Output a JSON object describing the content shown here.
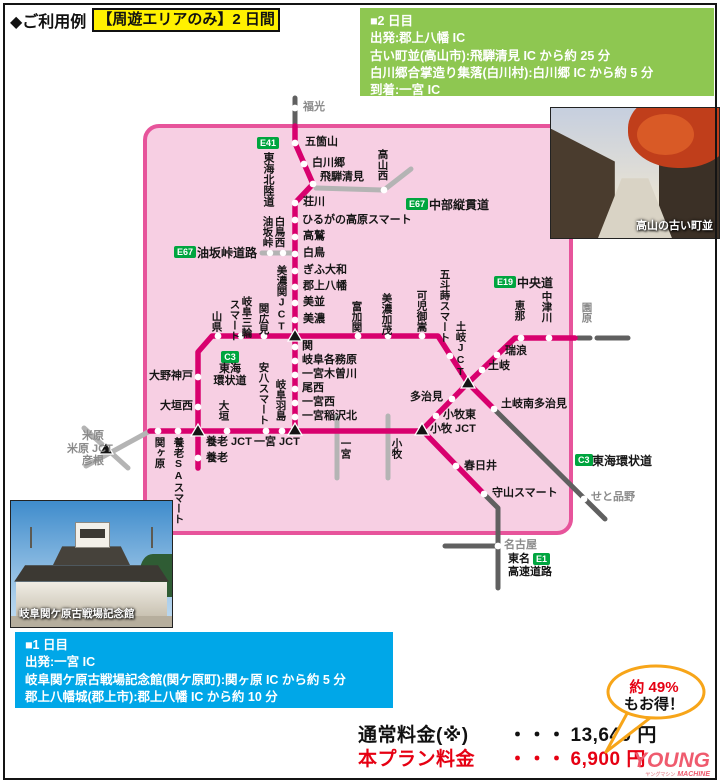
{
  "header": {
    "title": "◆ご利用例",
    "badge": "【周遊エリアのみ】2 日間"
  },
  "day2_box": {
    "lines": [
      "■2 日目",
      "出発:郡上八幡 IC",
      "古い町並(高山市):飛騨清見 IC から約 25 分",
      "白川郷合掌造り集落(白川村):白川郷 IC から約 5 分",
      "到着:一宮 IC"
    ]
  },
  "day1_box": {
    "lines": [
      "■1 日目",
      "出発:一宮 IC",
      "岐阜関ケ原古戦場記念館(関ケ原町):関ヶ原 IC から約 5 分",
      "郡上八幡城(郡上市):郡上八幡 IC から約 10 分"
    ]
  },
  "photos": {
    "takayama_caption": "高山の古い町並",
    "sekigahara_caption": "岐阜関ケ原古戦場記念館"
  },
  "pricing": {
    "normal_label": "通常料金(※)",
    "normal_dots": "・・・",
    "normal_value": "13,640 円",
    "plan_label": "本プラン料金",
    "plan_dots": "・・・",
    "plan_value": "6,900 円"
  },
  "bubble": {
    "line1": "約 49%",
    "line2": "もお得！"
  },
  "logo": {
    "young": "YOUNG",
    "machine": "MACHINE",
    "kana": "ヤングマシン"
  },
  "colors": {
    "area_fill": "#f7cfe3",
    "area_border": "#e7549b",
    "route_magenta": "#d8006e",
    "road_light_gray": "#b4b4b4",
    "road_dark_gray": "#606060",
    "badge_green": "#00a53f",
    "day2_green": "#8ec751",
    "day1_blue": "#00a7e8",
    "price_red": "#e60012",
    "highlight_yellow": "#fff100",
    "bubble_border": "#f7a519",
    "logo_red": "#ef5b6e"
  },
  "map": {
    "badges": {
      "e41": "E41",
      "e67": "E67",
      "e19": "E19",
      "c3": "C3",
      "e1": "E1"
    },
    "roads": {
      "tokaihokuriku": "東海北陸道",
      "aburasaka": "油坂峠道路",
      "chubu": "中部縦貫道",
      "chuo": "中央道",
      "tokaikanjo1": "東海",
      "tokaikanjo2": "環状道",
      "tokaikanjo": "東海環状道",
      "tomei1": "東名",
      "tomei2": "高速道路"
    },
    "labels": {
      "fukumitsu": "福光",
      "gokayama": "五箇山",
      "shirakawago": "白川郷",
      "hidakiyomi": "飛騨清見",
      "takayamanishi": "高山西",
      "shokawa": "荘川",
      "hirugano": "ひるがの高原スマート",
      "takasu": "高鷲",
      "shirotori": "白鳥",
      "aburasakatoge": "油坂峠",
      "shirotorinishi": "白鳥西",
      "gifuyamato": "ぎふ大和",
      "gujohachiman": "郡上八幡",
      "minami": "美並",
      "mino": "美濃",
      "minosekijct": "美濃関JCT",
      "yamagata": "山県",
      "smart": "スマート",
      "gifumiwa": "岐阜三輪",
      "sekihiromi": "関広見",
      "seki": "関",
      "gifukakamigahara": "岐阜各務原",
      "ichinomiyakisogawa": "一宮木曽川",
      "bisai": "尾西",
      "ichinomiyanishi": "一宮西",
      "ichinomiyainazawakita": "一宮稲沢北",
      "onokodo": "大野神戸",
      "ogakinishi": "大垣西",
      "yorojct": "養老 JCT",
      "yoro": "養老",
      "yorosasmart": "養老SAスマート",
      "sekigahara": "関ヶ原",
      "ogaki": "大垣",
      "anpachismart": "安八スマート",
      "gifuhashima": "岐阜羽島",
      "ichinomiyajct": "一宮 JCT",
      "ichinomiya": "一宮",
      "komaki": "小牧",
      "komakijct": "小牧 JCT",
      "komakihigashi": "小牧東",
      "tajimi": "多治見",
      "tomikaseki": "富加関",
      "minokamo": "美濃加茂",
      "kanimitake": "可児御嵩",
      "gotomaki": "五斗蒔スマート",
      "tokijct": "土岐JCT",
      "toki": "土岐",
      "mizunami": "瑞浪",
      "ena": "恵那",
      "nakatsugawa": "中津川",
      "sonohara": "園原",
      "tokiminamitajimi": "土岐南多治見",
      "setoshinano": "せと品野",
      "kasugai": "春日井",
      "moriyamasmart": "守山スマート",
      "nagoya": "名古屋",
      "maibara": "米原",
      "maibarajct": "米原 JCT",
      "hikone": "彦根"
    }
  }
}
